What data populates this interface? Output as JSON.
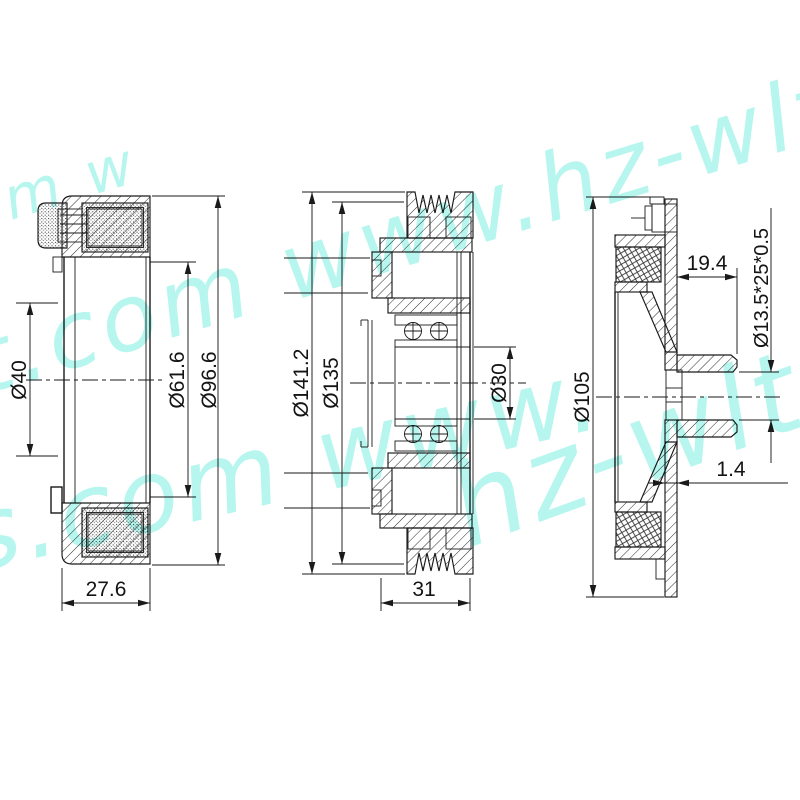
{
  "watermark": {
    "text": "www.hz-wlt.com",
    "color": "#6feedd",
    "band_top_text": "t.com www.hz-wlt",
    "band_bottom_text": "s.com www.",
    "band_bottom2_text": "hz-wlt",
    "corner_text": "om w"
  },
  "views": {
    "coil": {
      "title": "field-coil-section",
      "dim_bore": "Ø40",
      "dim_winding": "Ø61.6",
      "dim_outer": "Ø96.6",
      "dim_width": "27.6"
    },
    "pulley": {
      "title": "pulley-section",
      "dim_outer": "Ø141.2",
      "dim_groove": "Ø135",
      "dim_bore": "Ø30",
      "dim_width": "31"
    },
    "plate": {
      "title": "clutch-plate-section",
      "dim_outer": "Ø105",
      "dim_hub": "19.4",
      "dim_spec": "Ø13.5*25*0.5",
      "dim_gap": "1.4"
    }
  }
}
